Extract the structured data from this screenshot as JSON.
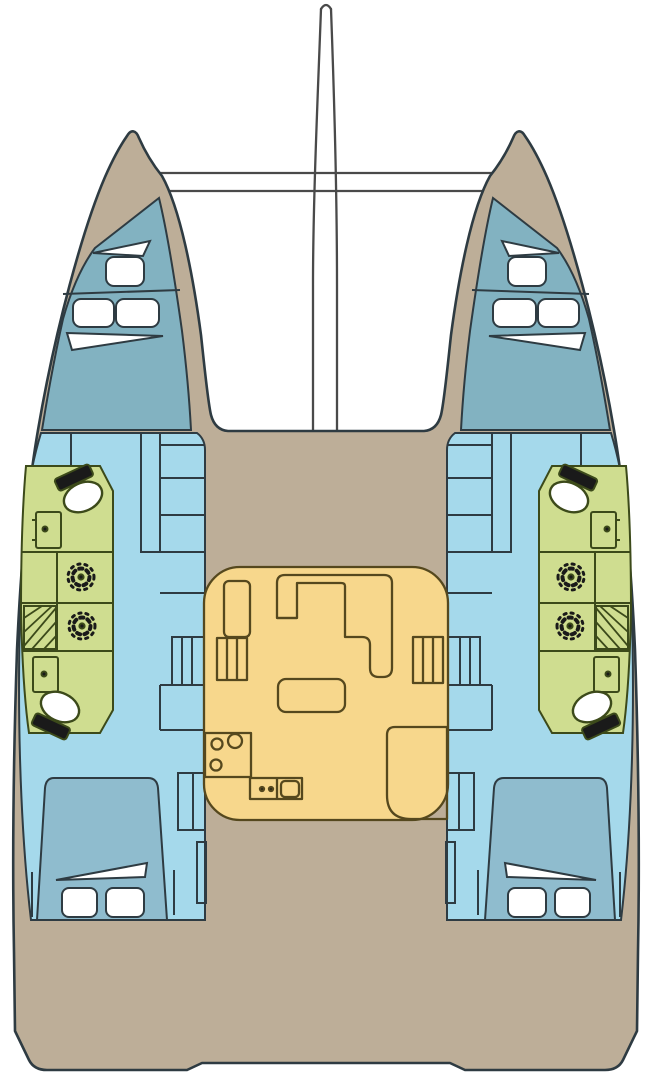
{
  "meta": {
    "diagram": "catamaran-accommodation-floor-plan",
    "view": "top-down deck plan",
    "visible_text": ""
  },
  "colors": {
    "background": "#FFFFFF",
    "deck": "#BDAE98",
    "outline": "#2E3B42",
    "hull_interior": "#A5D9EB",
    "forward_cabin": "#82B2C1",
    "bed": "#8FBCCE",
    "pillow": "#FFFFFF",
    "linen": "#FFFFFF",
    "head": "#CFDD90",
    "head_outline": "#3C4A1A",
    "salon": "#F7D78C",
    "salon_outline": "#55481E",
    "rigging": "#4A4A4A",
    "fixture_dark": "#1A1A1A"
  },
  "vessel": {
    "type": "catamaran",
    "hulls": [
      {
        "side": "port",
        "rooms": [
          {
            "name": "forward-cabin",
            "furniture": [
              "single-berth",
              "pillow",
              "double-berth",
              "pillow",
              "pillow",
              "linen-fold"
            ]
          },
          {
            "name": "forward-head",
            "fixtures": [
              "toilet",
              "sink"
            ]
          },
          {
            "name": "shower-forward",
            "fixtures": [
              "shower-drain"
            ]
          },
          {
            "name": "shower-aft",
            "fixtures": [
              "shower-drain",
              "louvered-locker"
            ]
          },
          {
            "name": "aft-head",
            "fixtures": [
              "sink",
              "toilet"
            ]
          },
          {
            "name": "aft-cabin",
            "furniture": [
              "double-berth",
              "pillow",
              "pillow",
              "linen-fold"
            ]
          },
          {
            "name": "companionway",
            "furniture": [
              "shelves",
              "steps",
              "wardrobe"
            ]
          }
        ]
      },
      {
        "side": "starboard",
        "mirrors": "port"
      }
    ],
    "salon": {
      "name": "salon-galley",
      "furniture": [
        "nav-seat",
        "port-entry-steps",
        "l-shaped-settee",
        "chaise-seat",
        "starboard-entry-steps",
        "three-burner-stove",
        "galley-sink",
        "corner-counter"
      ]
    },
    "rigging": [
      "forestay-a-frame",
      "forward-crossbeam",
      "trampoline-edge"
    ]
  }
}
